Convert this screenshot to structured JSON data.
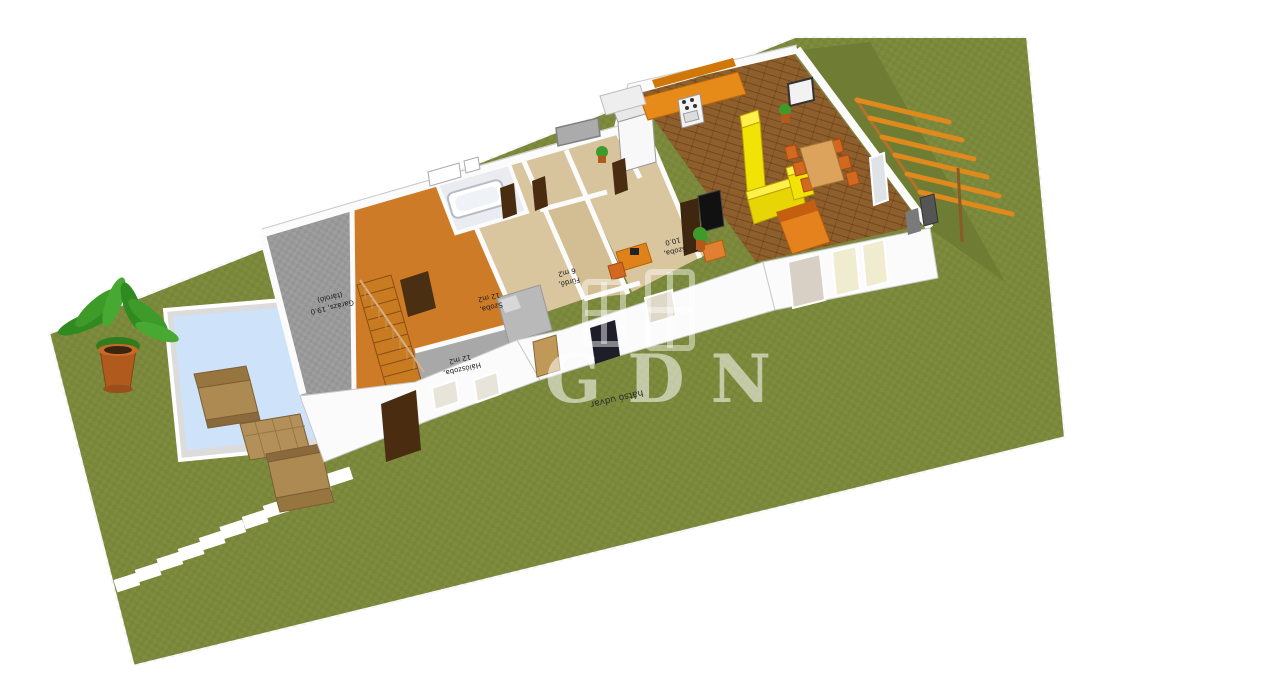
{
  "watermark": {
    "text": "GDN"
  },
  "room_labels": {
    "garage": {
      "line1": "Garázs, 19.0",
      "line2": "(tároló)"
    },
    "room_small": {
      "line1": "Szoba,",
      "line2": "12 m2"
    },
    "bedroom_front": {
      "line1": "Hálószoba,",
      "line2": "12 m2"
    },
    "bathroom": {
      "line1": "Fürdő,",
      "line2": "6 m2"
    },
    "room_office": {
      "line1": "Szoba,",
      "line2": "10.0"
    }
  },
  "yard_labels": {
    "back_yard": "hátsó udvar"
  },
  "colors": {
    "background": "#FFFFFF",
    "grass": "#7E8C3D",
    "patio_green": "#6E7C34",
    "plot_edge": "#FFFFFF",
    "pool_water": "#CEE2FA",
    "pool_deck": "#DCDCDC",
    "wall": "#FBFBFB",
    "wall_shadow": "#C9C9C9",
    "floor_gray": "#9E9E9E",
    "floor_orange": "#CE7B28",
    "floor_wood_light": "#D9C69E",
    "floor_parquet": "#8E5F2C",
    "cabinet_orange": "#E68A1A",
    "bar_yellow": "#F2E307",
    "bar_yellow_side": "#D9C400",
    "chair_orange": "#D2691E",
    "table_wood": "#DBA35C",
    "sofa_orange": "#E5821E",
    "stair_wood": "#C97B22",
    "door_dark": "#4A2C10",
    "door_wood": "#C09858",
    "bed_gray": "#B9B9B9",
    "pot_terracotta": "#B05A1E",
    "leaf_green": "#3E9B2A",
    "wicker": "#AD8A52",
    "pergola_beam": "#E08A1E",
    "grill_gray": "#555555",
    "tv_black": "#111111"
  }
}
